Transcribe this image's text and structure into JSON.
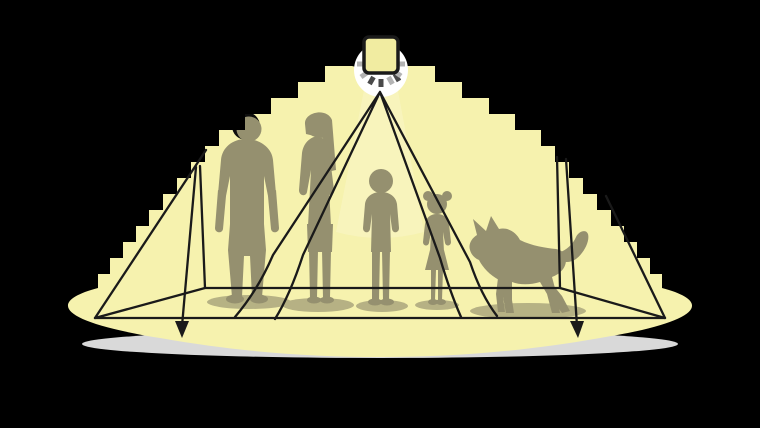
{
  "scene": {
    "figures": [
      {
        "name": "man"
      },
      {
        "name": "woman"
      },
      {
        "name": "boy"
      },
      {
        "name": "girl"
      },
      {
        "name": "dog"
      }
    ],
    "colors": {
      "background": "#000000",
      "light_cone": "#f6f2ae",
      "beam_highlight": "#fdfad6",
      "sensor_glow": "#ffffff",
      "sensor_fill": "#f1eca1",
      "outline": "#1a1a1a",
      "silhouette": "#95906f",
      "silhouette_shadow": "#827d62",
      "unlit": "#0d0d0d",
      "floor_glow": "#d9d9d9",
      "ray_dark": "#4a4a4a",
      "ray_light": "#b3b3b3"
    }
  }
}
